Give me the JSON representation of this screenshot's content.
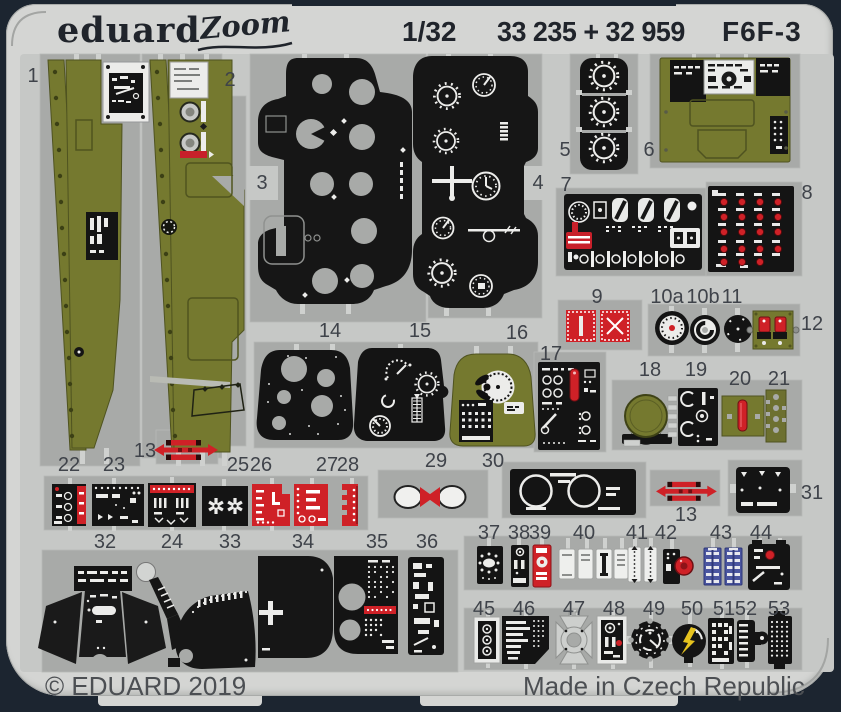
{
  "header": {
    "brand": "eduard",
    "series_logo": "Zoom",
    "scale": "1/32",
    "catalog_numbers": "33 235 + 32 959",
    "aircraft": "F6F-3"
  },
  "footer": {
    "copyright": "© EDUARD 2019",
    "made_in": "Made in Czech Republic"
  },
  "colors": {
    "background_navy": "#1c2530",
    "fret_metal": "#d4d5d3",
    "fret_field": "#c6c8c6",
    "carrier_film": "#a8aaa8",
    "paint_olive": "#75792f",
    "paint_black": "#141414",
    "paint_red": "#cf2127",
    "paint_blue": "#4a55a0",
    "paint_yellow": "#e6c31f",
    "bare_metal": "#cdcfcd",
    "label_ink": "#3f434a"
  },
  "part_labels": [
    {
      "n": "1",
      "x": 33,
      "y": 66
    },
    {
      "n": "2",
      "x": 230,
      "y": 70
    },
    {
      "n": "3",
      "x": 262,
      "y": 173
    },
    {
      "n": "4",
      "x": 538,
      "y": 173
    },
    {
      "n": "5",
      "x": 565,
      "y": 140
    },
    {
      "n": "6",
      "x": 649,
      "y": 140
    },
    {
      "n": "7",
      "x": 566,
      "y": 175
    },
    {
      "n": "8",
      "x": 807,
      "y": 183
    },
    {
      "n": "9",
      "x": 597,
      "y": 287
    },
    {
      "n": "10a",
      "x": 667,
      "y": 287
    },
    {
      "n": "10b",
      "x": 703,
      "y": 287
    },
    {
      "n": "11",
      "x": 732,
      "y": 287
    },
    {
      "n": "12",
      "x": 812,
      "y": 314
    },
    {
      "n": "13",
      "x": 145,
      "y": 441
    },
    {
      "n": "14",
      "x": 330,
      "y": 321
    },
    {
      "n": "15",
      "x": 420,
      "y": 321
    },
    {
      "n": "16",
      "x": 517,
      "y": 323
    },
    {
      "n": "17",
      "x": 551,
      "y": 344
    },
    {
      "n": "18",
      "x": 650,
      "y": 360
    },
    {
      "n": "19",
      "x": 696,
      "y": 360
    },
    {
      "n": "20",
      "x": 740,
      "y": 369
    },
    {
      "n": "21",
      "x": 779,
      "y": 369
    },
    {
      "n": "22",
      "x": 69,
      "y": 455
    },
    {
      "n": "23",
      "x": 114,
      "y": 455
    },
    {
      "n": "25",
      "x": 238,
      "y": 455
    },
    {
      "n": "26",
      "x": 261,
      "y": 455
    },
    {
      "n": "27",
      "x": 327,
      "y": 455
    },
    {
      "n": "28",
      "x": 348,
      "y": 455
    },
    {
      "n": "29",
      "x": 436,
      "y": 451
    },
    {
      "n": "30",
      "x": 493,
      "y": 451
    },
    {
      "n": "13",
      "x": 686,
      "y": 505
    },
    {
      "n": "31",
      "x": 812,
      "y": 483
    },
    {
      "n": "32",
      "x": 105,
      "y": 532
    },
    {
      "n": "24",
      "x": 172,
      "y": 532
    },
    {
      "n": "33",
      "x": 230,
      "y": 532
    },
    {
      "n": "34",
      "x": 303,
      "y": 532
    },
    {
      "n": "35",
      "x": 377,
      "y": 532
    },
    {
      "n": "36",
      "x": 427,
      "y": 532
    },
    {
      "n": "37",
      "x": 489,
      "y": 523
    },
    {
      "n": "38",
      "x": 519,
      "y": 523
    },
    {
      "n": "39",
      "x": 540,
      "y": 523
    },
    {
      "n": "40",
      "x": 584,
      "y": 523
    },
    {
      "n": "41",
      "x": 637,
      "y": 523
    },
    {
      "n": "42",
      "x": 666,
      "y": 523
    },
    {
      "n": "43",
      "x": 721,
      "y": 523
    },
    {
      "n": "44",
      "x": 761,
      "y": 523
    },
    {
      "n": "45",
      "x": 484,
      "y": 599
    },
    {
      "n": "46",
      "x": 524,
      "y": 599
    },
    {
      "n": "47",
      "x": 574,
      "y": 599
    },
    {
      "n": "48",
      "x": 614,
      "y": 599
    },
    {
      "n": "49",
      "x": 654,
      "y": 599
    },
    {
      "n": "50",
      "x": 692,
      "y": 599
    },
    {
      "n": "51",
      "x": 724,
      "y": 599
    },
    {
      "n": "52",
      "x": 746,
      "y": 599
    },
    {
      "n": "53",
      "x": 779,
      "y": 599
    }
  ]
}
